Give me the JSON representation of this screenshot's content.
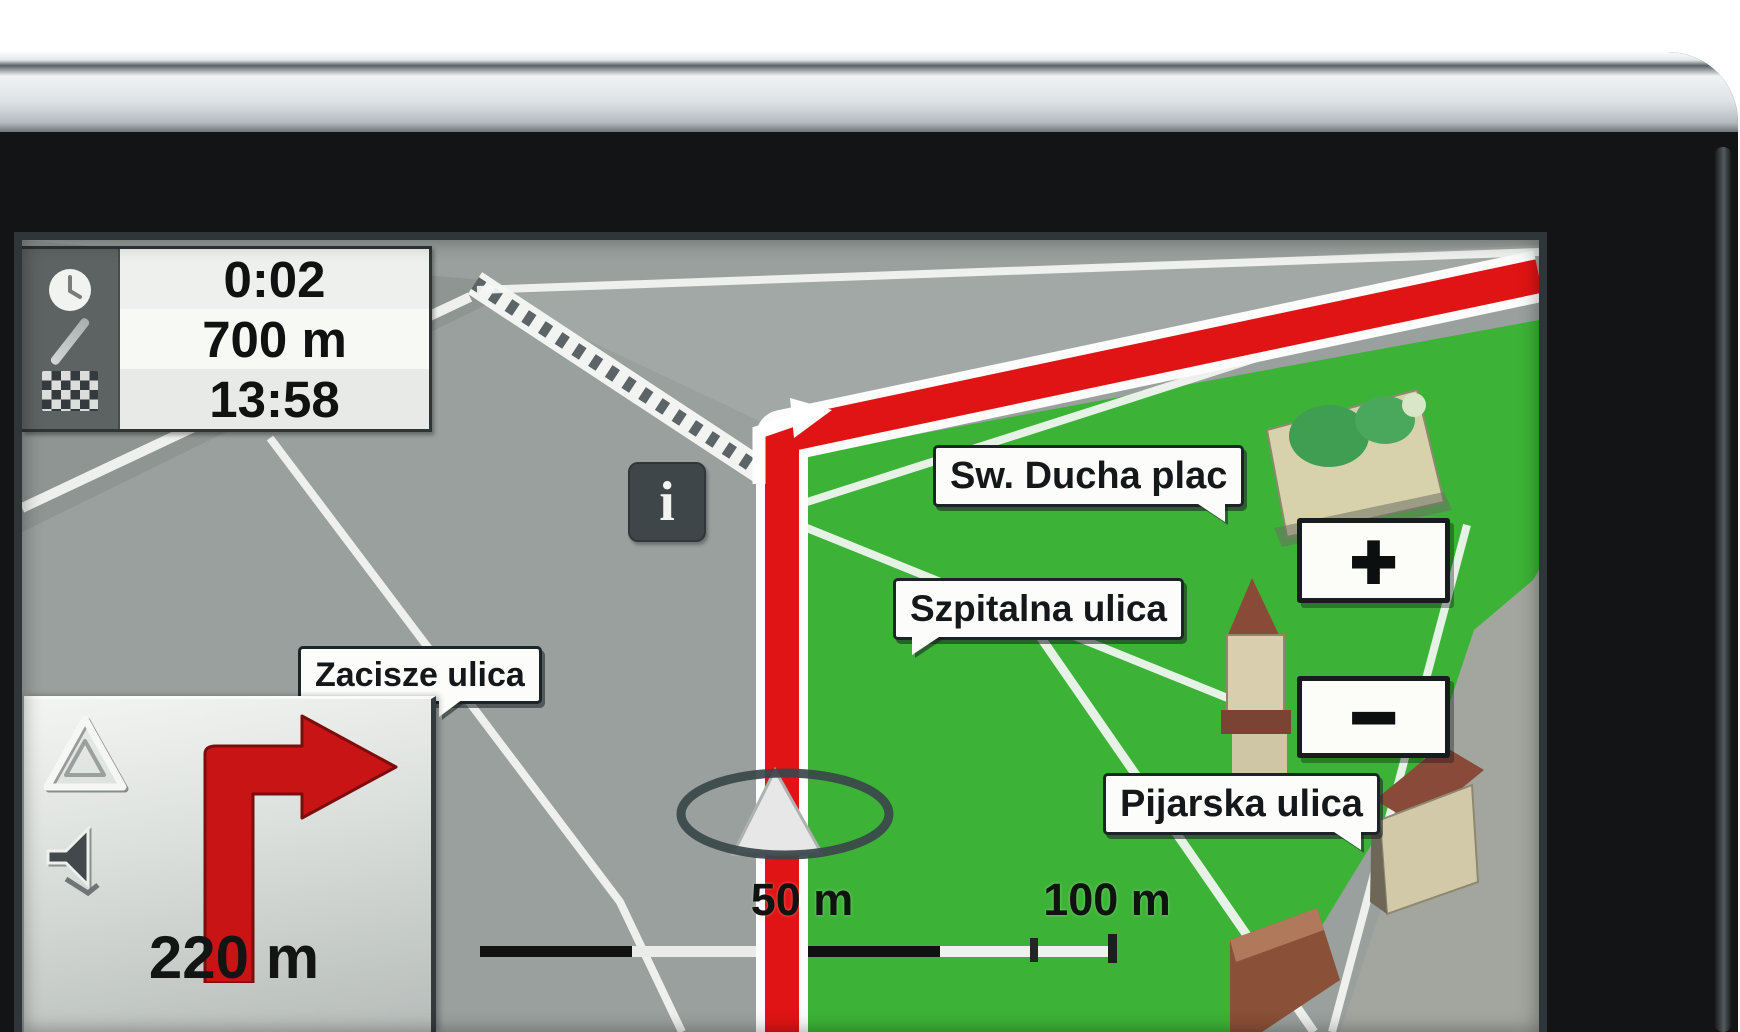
{
  "app": {
    "title": "GPS navigation map view"
  },
  "colors": {
    "route_red": "#e01414",
    "map_gray": "#9aa09e",
    "map_green": "#3cb336",
    "bezel_black": "#121416",
    "label_background": "#fcfdfa",
    "trip_icon_column": "#5d6362",
    "turn_arrow_red": "#c81414"
  },
  "trip_info_panel": {
    "time_remaining": "0:02",
    "distance_remaining": "700 m",
    "arrival_time": "13:58",
    "icons": {
      "clock": "clock-icon",
      "route": "route-segment-icon",
      "finish": "checkered-flag-icon"
    }
  },
  "map": {
    "street_labels": [
      {
        "text": "Sw. Ducha plac"
      },
      {
        "text": "Szpitalna ulica"
      },
      {
        "text": "Zacisze ulica"
      },
      {
        "text": "Pijarska ulica"
      }
    ],
    "info_button_glyph": "i",
    "scale": {
      "first": "50 m",
      "second": "100 m"
    },
    "vehicle_marker": "position-ring-marker"
  },
  "zoom_controls": {
    "zoom_in": "+",
    "zoom_out": "−"
  },
  "turn_panel": {
    "maneuver": "turn-right",
    "distance_to_turn": "220 m",
    "icons": {
      "hazard": "hazard-triangle-icon",
      "mute": "speaker-muted-icon"
    }
  }
}
